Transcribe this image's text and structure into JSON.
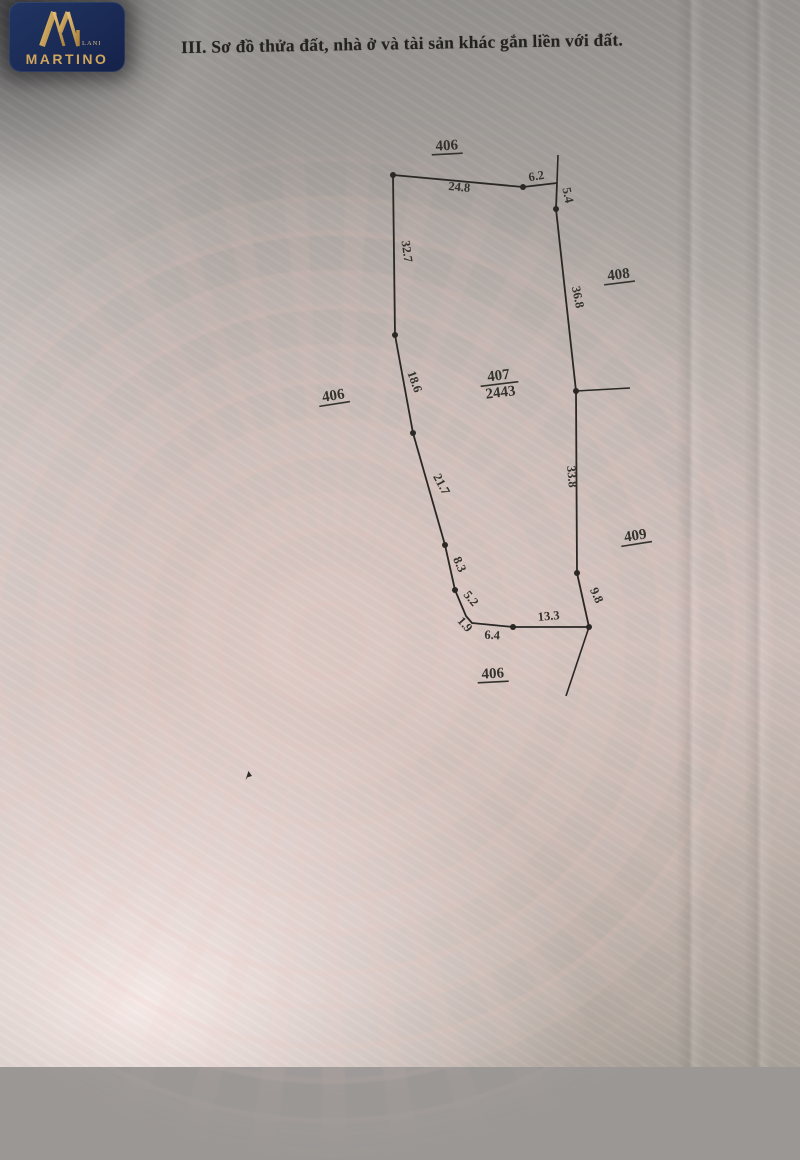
{
  "logo": {
    "brand": "MARTINO",
    "sub": "LAND",
    "bg_color": "#1b2d5e",
    "gold_color": "#cfa55b"
  },
  "header": {
    "title": "III. Sơ đồ thửa đất, nhà ở và tài sản khác gắn liền với đất."
  },
  "diagram": {
    "stroke_color": "#2a2825",
    "label_color": "#34322c",
    "boundary": [
      [
        393,
        175
      ],
      [
        523,
        187
      ],
      [
        557,
        183
      ],
      [
        556,
        209
      ],
      [
        576,
        391
      ],
      [
        577,
        573
      ],
      [
        589,
        627
      ],
      [
        513,
        627
      ],
      [
        472,
        623
      ],
      [
        466,
        616
      ],
      [
        455,
        590
      ],
      [
        445,
        545
      ],
      [
        413,
        433
      ],
      [
        395,
        335
      ]
    ],
    "extra_lines": [
      {
        "name": "boundary-408-extension-top",
        "points": [
          [
            558,
            155
          ],
          [
            557,
            183
          ]
        ]
      },
      {
        "name": "boundary-tick-east",
        "points": [
          [
            576,
            391
          ],
          [
            630,
            388
          ]
        ]
      },
      {
        "name": "boundary-extension-bottom",
        "points": [
          [
            589,
            627
          ],
          [
            566,
            696
          ]
        ]
      }
    ],
    "vertex_dots": [
      [
        393,
        175
      ],
      [
        523,
        187
      ],
      [
        556,
        209
      ],
      [
        576,
        391
      ],
      [
        577,
        573
      ],
      [
        589,
        627
      ],
      [
        513,
        627
      ],
      [
        455,
        590
      ],
      [
        445,
        545
      ],
      [
        413,
        433
      ],
      [
        395,
        335
      ]
    ],
    "edge_labels": [
      {
        "text": "24.8",
        "x": 459,
        "y": 191,
        "rotate": 5
      },
      {
        "text": "6.2",
        "x": 537,
        "y": 180,
        "rotate": -10
      },
      {
        "text": "5.4",
        "x": 564,
        "y": 196,
        "rotate": 78
      },
      {
        "text": "36.8",
        "x": 574,
        "y": 298,
        "rotate": 78
      },
      {
        "text": "33.8",
        "x": 568,
        "y": 477,
        "rotate": 85
      },
      {
        "text": "9.8",
        "x": 593,
        "y": 597,
        "rotate": 65
      },
      {
        "text": "13.3",
        "x": 549,
        "y": 620,
        "rotate": -5
      },
      {
        "text": "6.4",
        "x": 492,
        "y": 639,
        "rotate": 3
      },
      {
        "text": "1.9",
        "x": 462,
        "y": 627,
        "rotate": 48
      },
      {
        "text": "5.2",
        "x": 468,
        "y": 601,
        "rotate": 50
      },
      {
        "text": "8.3",
        "x": 456,
        "y": 566,
        "rotate": 66
      },
      {
        "text": "21.7",
        "x": 438,
        "y": 486,
        "rotate": 62
      },
      {
        "text": "18.6",
        "x": 411,
        "y": 383,
        "rotate": 70
      },
      {
        "text": "32.7",
        "x": 403,
        "y": 252,
        "rotate": 82
      }
    ],
    "parcel_labels": [
      {
        "text": "406",
        "x": 447,
        "y": 150,
        "rotate": -3
      },
      {
        "text": "408",
        "x": 619,
        "y": 279,
        "rotate": -7
      },
      {
        "text": "406",
        "x": 334,
        "y": 400,
        "rotate": -9
      },
      {
        "text": "409",
        "x": 636,
        "y": 540,
        "rotate": -9
      },
      {
        "text": "406",
        "x": 493,
        "y": 678,
        "rotate": -3
      }
    ],
    "parcel_fraction": {
      "top": "407",
      "bottom": "2443",
      "x": 499,
      "y": 380,
      "rotate": -7
    }
  }
}
